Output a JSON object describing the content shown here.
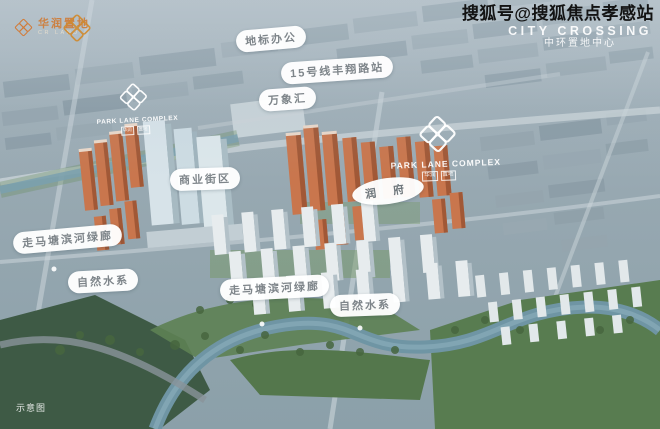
{
  "watermark": {
    "sohu_account": "搜狐号@搜狐焦点孝感站",
    "project_en": "CITY CROSSING",
    "project_cn": "中环置地中心"
  },
  "branding": {
    "developer_cn": "华润置地",
    "developer_en": "CR LAND",
    "parklane_title": "PARK LANE COMPLEX",
    "parklane_seal_left": "华润",
    "parklane_seal_right": "置地"
  },
  "map_labels": {
    "landmark_office": "地标办公",
    "metro_station": "15号线丰翔路站",
    "mixc_mall": "万象汇",
    "commercial_street": "商业街区",
    "residence": "润 府",
    "greenway_west": "走马塘滨河绿廊",
    "natural_water_west": "自然水系",
    "greenway_south": "走马塘滨河绿廊",
    "natural_water_south": "自然水系"
  },
  "footnote": "示意图",
  "colors": {
    "brand_orange": "#d4772f",
    "tower_orange": "#c9764d",
    "pill_text_gray": "#7e858a",
    "river_blue": "#6f95a4",
    "park_green": "#587c50"
  }
}
